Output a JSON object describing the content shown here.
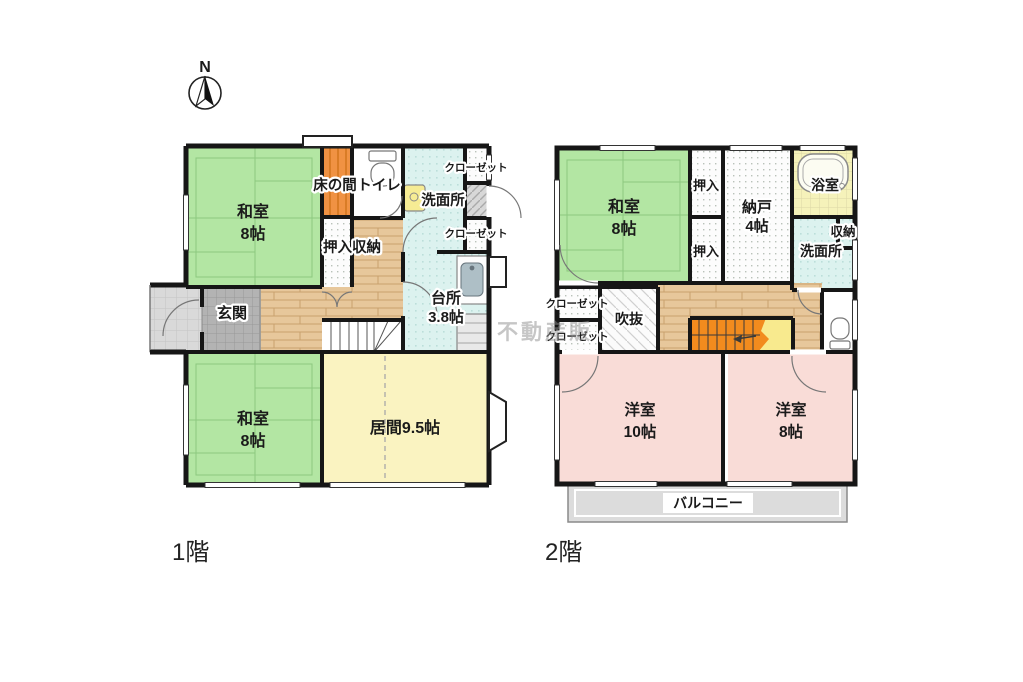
{
  "compass": {
    "label": "N"
  },
  "watermark": {
    "text": "不動産販"
  },
  "f1": {
    "caption": "1階",
    "washitsu_top_name": "和室",
    "washitsu_top_size": "8帖",
    "tokonoma": "床の間",
    "toilet": "トイレ",
    "senmenjo": "洗面所",
    "closet_top": "クローゼット",
    "closet_mid": "クローゼット",
    "oshiire": "押入収納",
    "genkan": "玄関",
    "kitchen_name": "台所",
    "kitchen_size": "3.8帖",
    "washitsu_bottom_name": "和室",
    "washitsu_bottom_size": "8帖",
    "living": "居間9.5帖"
  },
  "f2": {
    "caption": "2階",
    "washitsu_name": "和室",
    "washitsu_size": "8帖",
    "oshiire_top": "押入",
    "oshiire_bottom": "押入",
    "nando_name": "納戸",
    "nando_size": "4帖",
    "yokushitsu": "浴室",
    "shuno": "収納",
    "senmenjo": "洗面所",
    "closet_top": "クローゼット",
    "closet_bottom": "クローゼット",
    "fukinuke": "吹抜",
    "yoshitsu10_name": "洋室",
    "yoshitsu10_size": "10帖",
    "yoshitsu8_name": "洋室",
    "yoshitsu8_size": "8帖",
    "balcony": "バルコニー"
  }
}
